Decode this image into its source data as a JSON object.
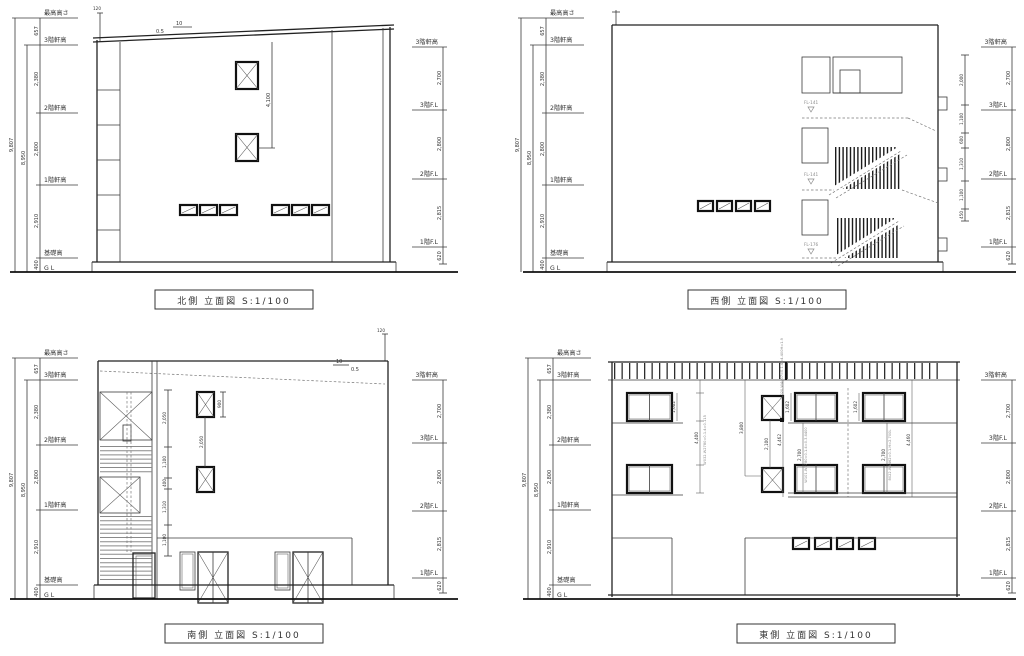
{
  "sheet": {
    "bg": "#ffffff",
    "line_color": "#2a2a2a",
    "gray_color": "#8a8a8a"
  },
  "captions": {
    "north": "北側 立面図 S:1/100",
    "west": "西側 立面図 S:1/100",
    "south": "南側 立面図 S:1/100",
    "east": "東側 立面図 S:1/100"
  },
  "left_scale": {
    "labels": {
      "max": "最高高さ",
      "f3": "3階軒高",
      "f2": "2階軒高",
      "f1": "1階軒高",
      "base": "基礎高",
      "gl": "G L"
    },
    "total": "9,807",
    "subtotal": "8,950",
    "segments": {
      "top": "657",
      "s3": "2,380",
      "s2": "2,800",
      "s1": "2,910",
      "base": "400"
    }
  },
  "right_scale": {
    "labels": {
      "f3e": "3階軒高",
      "f3": "3階F.L",
      "f2": "2階F.L",
      "f1": "1階F.L"
    },
    "segments": {
      "s3": "2,700",
      "s2": "2,800",
      "s1": "2,815",
      "base": "620"
    }
  },
  "north": {
    "antenna": "120",
    "slope_run": "10",
    "slope_rise": "0.5",
    "window_dim": "4,100"
  },
  "west": {
    "fl_labels": [
      "FL-141",
      "FL-141",
      "FL-176"
    ],
    "chain": [
      "2,000",
      "1,100",
      "600",
      "1,310",
      "1,100",
      "450"
    ]
  },
  "south": {
    "antenna": "120",
    "slope_run": "10",
    "slope_rise": "0.5",
    "chain": [
      "2,050",
      "1,100",
      "400",
      "1,310",
      "1,100"
    ],
    "window_height": "900",
    "window_gap": "2,050"
  },
  "east": {
    "left_window": "1,602",
    "left_chain": "4,400",
    "center_left": "3,800",
    "center": "2,100",
    "center_right": "4,462",
    "mid_window": "1,602",
    "right_window": "1,602",
    "low_mid": "2,700",
    "low_right": "2,700",
    "right_chain": "4,460",
    "spec1": "8020.W4407=0.1.4=4.400H=1.9",
    "spec2": "W032.W2780=0.1.4=0.115",
    "spec3": "W101.W2780=0.1.4=0.3.4400",
    "spec4": "8022.W4462=0.1.H=2.700L"
  }
}
